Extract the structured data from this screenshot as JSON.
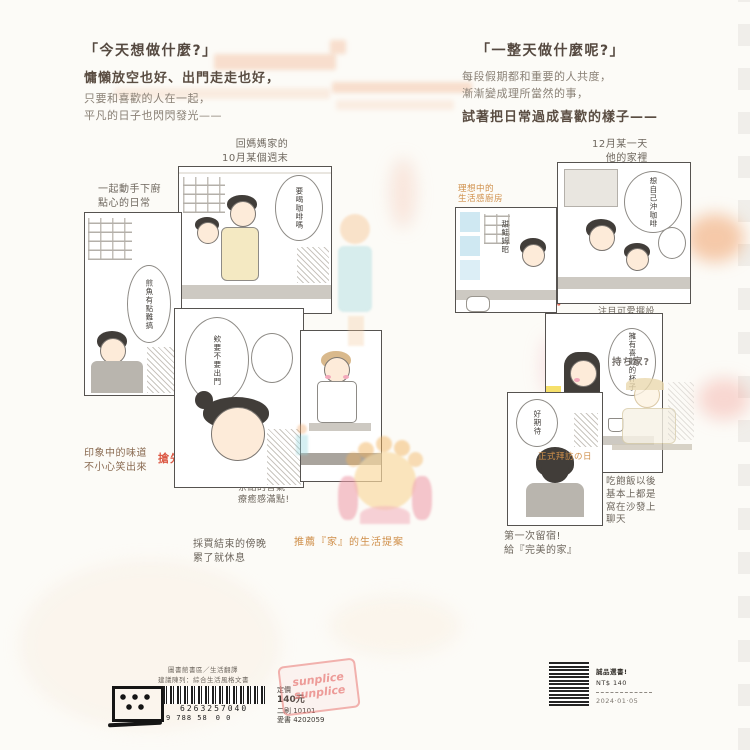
{
  "colors": {
    "background": "#fcfbf7",
    "accent_orange": "#cf8f4a",
    "highlight_red": "#d8452f",
    "stamp_pink": "#e97a76",
    "panel_border": "#565350"
  },
  "left_page": {
    "header": {
      "title": "「今天想做什麼?」",
      "bold_line": "慵懶放空也好、出門走走也好，",
      "sub_line1": "只要和喜歡的人在一起，",
      "sub_line2": "平凡的日子也閃閃發光——"
    },
    "caption_date_1": "回媽媽家的",
    "caption_date_2": "10月某個週末",
    "caption_share_1": "一起動手下廚",
    "caption_share_2": "點心的日常",
    "caption_snack_1": "印象中的味道",
    "caption_snack_2": "不小心笑出來",
    "caption_tea_1": "茶點的香氣",
    "caption_tea_2": "療癒感滿點!",
    "caption_rest_1": "採買結束的傍晚",
    "caption_rest_2": "累了就休息",
    "red_note": "搶先試閱第２話!",
    "bubble_coffee": "要喝咖啡嗎",
    "bubble_fish": "煎魚有點難搞",
    "bubble_today": "欸要不要出門"
  },
  "right_page": {
    "header": {
      "title": "「一整天做什麼呢?」",
      "sub_line1": "每段假期都和重要的人共度，",
      "sub_line2": "漸漸變成理所當然的事，",
      "bold_line": "試著把日常過成喜歡的樣子——"
    },
    "caption_date_1": "12月某一天",
    "caption_date_2": "他的家裡",
    "caption_kitchen_1": "理想中的",
    "caption_kitchen_2": "生活感廚房",
    "caption_room_1": "小巧房間裡",
    "caption_room_2": "注目可愛擺設",
    "red_note": "同居日常大公開!",
    "caption_visit": "正式拜訪の日",
    "caption_sofa_1": "吃飽飯以後",
    "caption_sofa_2": "基本上都是",
    "caption_sofa_3": "窩在沙發上",
    "caption_sofa_4": "聊天",
    "caption_stay_1": "第一次留宿!",
    "caption_stay_2": "給『完美的家』",
    "bubble_brew": "想自己沖咖啡",
    "bubble_cup": "擁有喜歡的杯子",
    "bubble_stay": "好期待",
    "panel_vtext": "甜鮭姆昭",
    "desk_note": "持ち家?"
  },
  "center": {
    "recommend": "推薦『家』的生活提案"
  },
  "footer": {
    "meta1": "圖書館書區／生活翻譯",
    "meta2": "建議陳列：綜合生活風格文書",
    "isbn_digits": "6263257040",
    "isbn_digits2": "9 788 58　0 0",
    "price_label": "定價",
    "price_value": "140元",
    "code1": "二刷 10101",
    "code2": "愛書 4202059",
    "stamp_line1": "sunplice",
    "stamp_line2": "sunplice",
    "sticker_line1": "誠品選書!",
    "sticker_line2": "NT$ 140",
    "sticker_line3": "2024·01·05"
  }
}
